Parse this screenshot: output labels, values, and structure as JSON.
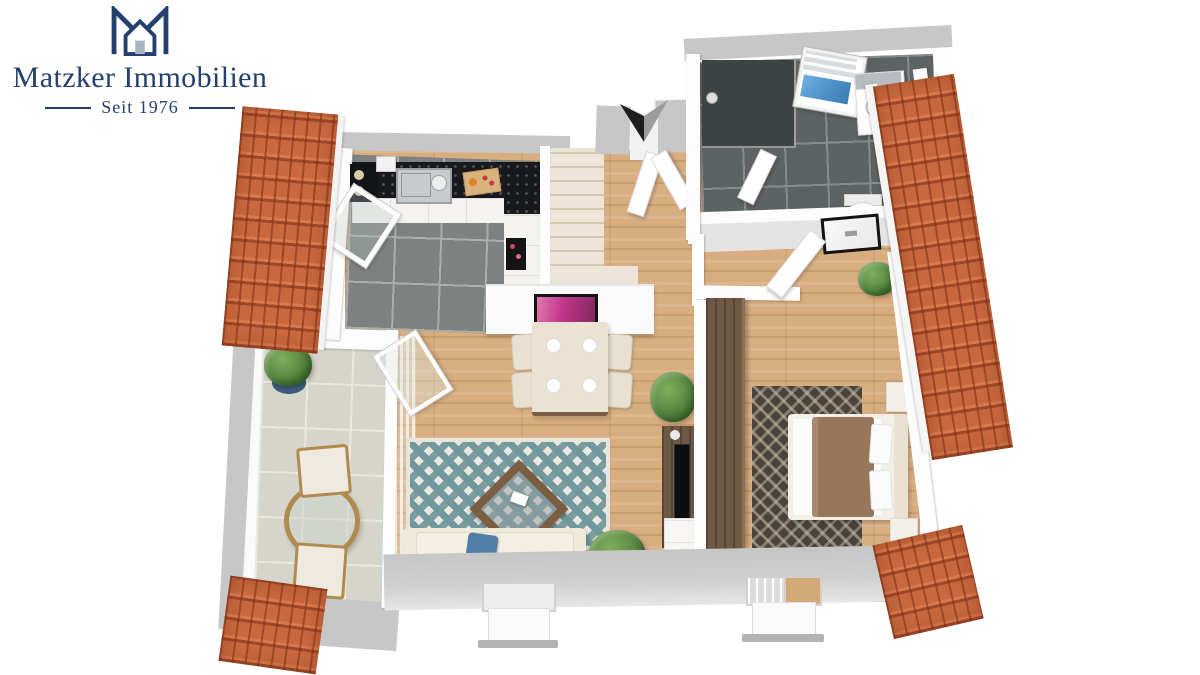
{
  "brand": {
    "title": "Matzker Immobilien",
    "tagline": "Seit 1976",
    "color": "#24406f",
    "icon": "m-house-logo-icon"
  },
  "floorplan": {
    "view": "3d-top-down-attic-floor-plan",
    "compass": {
      "icon": "north-arrow-icon",
      "style": "two-tone chevron, dark left half, gray right half"
    },
    "palette": {
      "roof_tile_orange": "#c7683e",
      "oak_parquet": "#d8ae80",
      "kitchen_tile_gray": "#7d8280",
      "bathroom_tile_anthracite": "#5d6263",
      "terrace_stone": "#d5d5cb",
      "exterior_wall_gray": "#c7c7c7",
      "interior_wall_white": "#fdfdfd",
      "worktop_black": "#17191c",
      "stairs_cream": "#ece5d7",
      "living_rug_teal": "#71989d",
      "bedroom_rug_dark": "#4a433b",
      "bed_blanket_brown": "#97775b",
      "pillow_blue": "#4f7fa8",
      "skylight_glass_blue": "#4f93cc",
      "art_pink": "#c2348a"
    },
    "rooms": [
      {
        "name": "kitchen",
        "floor": "gray tile",
        "features": [
          "l-shaped counter with black worktop",
          "sink with faucet",
          "cooktop",
          "cutting board with food",
          "open tilt window"
        ]
      },
      {
        "name": "hallway",
        "floor": "oak parquet",
        "features": [
          "winder staircase",
          "open entry doors",
          "north arrow above entry"
        ]
      },
      {
        "name": "bathroom",
        "floor": "anthracite tile",
        "features": [
          "walk-in shower",
          "blue skylight window",
          "vanity washbasin with mirror",
          "toilet",
          "roof window on slope"
        ]
      },
      {
        "name": "living-dining-room",
        "floor": "oak parquet",
        "features": [
          "dining table with four chairs and plates",
          "pink wall art on half wall",
          "teal diamond rug",
          "wood coffee table",
          "cream sofa with blue throw and pillow",
          "tv panel with media console",
          "potted plants",
          "dormer window",
          "sheer curtain"
        ]
      },
      {
        "name": "bedroom",
        "floor": "oak parquet",
        "features": [
          "double bed with brown cover",
          "dark patterned rug",
          "tall dark-wood wardrobe",
          "two nightstands",
          "dormer window",
          "potted plants"
        ]
      },
      {
        "name": "terrace",
        "floor": "stone tile",
        "features": [
          "round glass bistro table",
          "two wooden chairs",
          "plant in blue pot"
        ]
      }
    ],
    "exterior": [
      "orange tiled roof slopes on left and right",
      "gray eaves band with two dormers at bottom"
    ]
  }
}
